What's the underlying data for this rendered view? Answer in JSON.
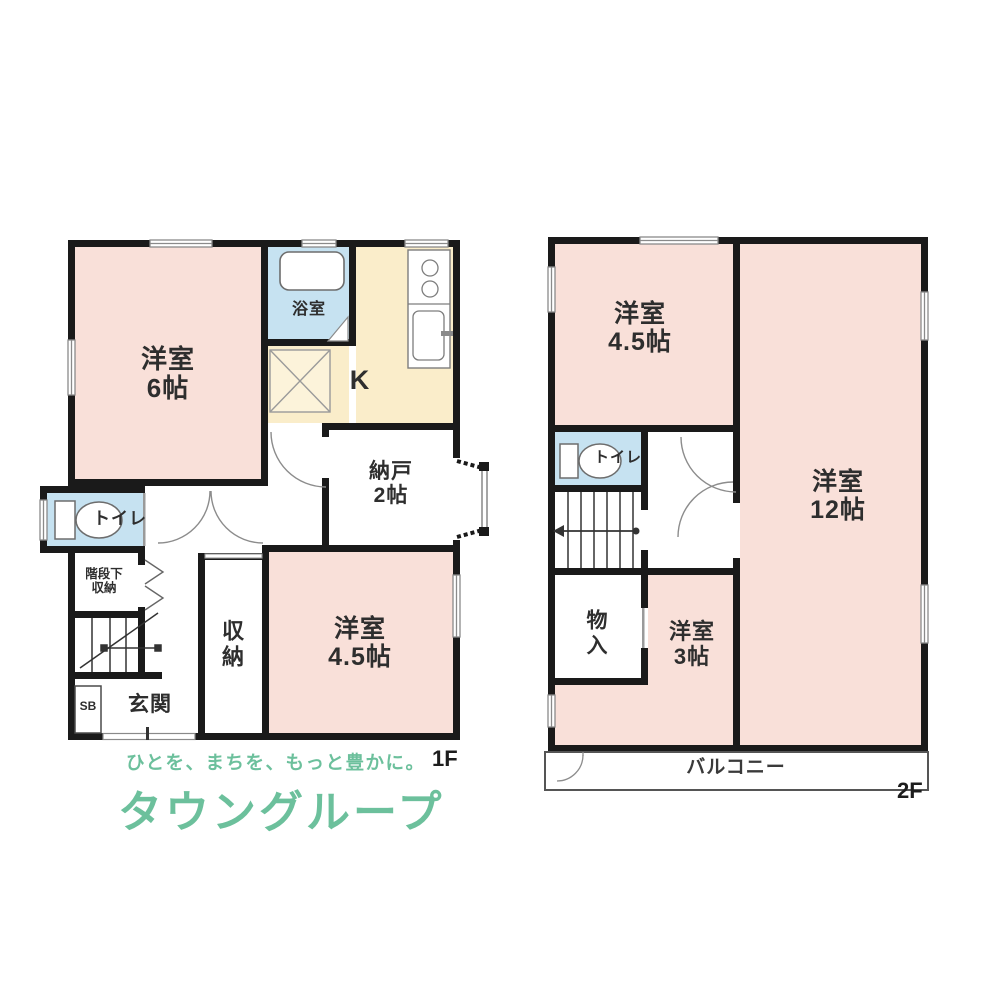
{
  "colors": {
    "room_pink": "#f9e0d9",
    "wet_area_blue": "#c6e2f1",
    "kitchen_cream": "#faedca",
    "wall_black": "#1a1a1a",
    "brand_green": "#6cc09c",
    "brand_square_green": "#74c4a0"
  },
  "floor1": {
    "label": "1F",
    "rooms": {
      "yoshitsu6": {
        "name": "洋室",
        "size": "6帖"
      },
      "bathroom": {
        "name": "浴室"
      },
      "kitchen": {
        "name": "K"
      },
      "nando": {
        "name": "納戸",
        "size": "2帖"
      },
      "toilet": {
        "name": "トイレ"
      },
      "under_stair_storage": {
        "line1": "階段下",
        "line2": "収納"
      },
      "storage": {
        "name": "収納"
      },
      "yoshitsu45": {
        "name": "洋室",
        "size": "4.5帖"
      },
      "entrance": {
        "name": "玄関"
      },
      "shoebox": {
        "name": "SB"
      }
    }
  },
  "floor2": {
    "label": "2F",
    "rooms": {
      "yoshitsu45": {
        "name": "洋室",
        "size": "4.5帖"
      },
      "yoshitsu12": {
        "name": "洋室",
        "size": "12帖"
      },
      "toilet": {
        "name": "トイレ"
      },
      "closet": {
        "name": "物入"
      },
      "yoshitsu3": {
        "name": "洋室",
        "size": "3帖"
      },
      "balcony": {
        "name": "バルコニー"
      }
    }
  },
  "branding": {
    "logo_text": "TOWN GROUP",
    "tagline": "ひとを、まちを、もっと豊かに。",
    "company": "タウングループ"
  }
}
